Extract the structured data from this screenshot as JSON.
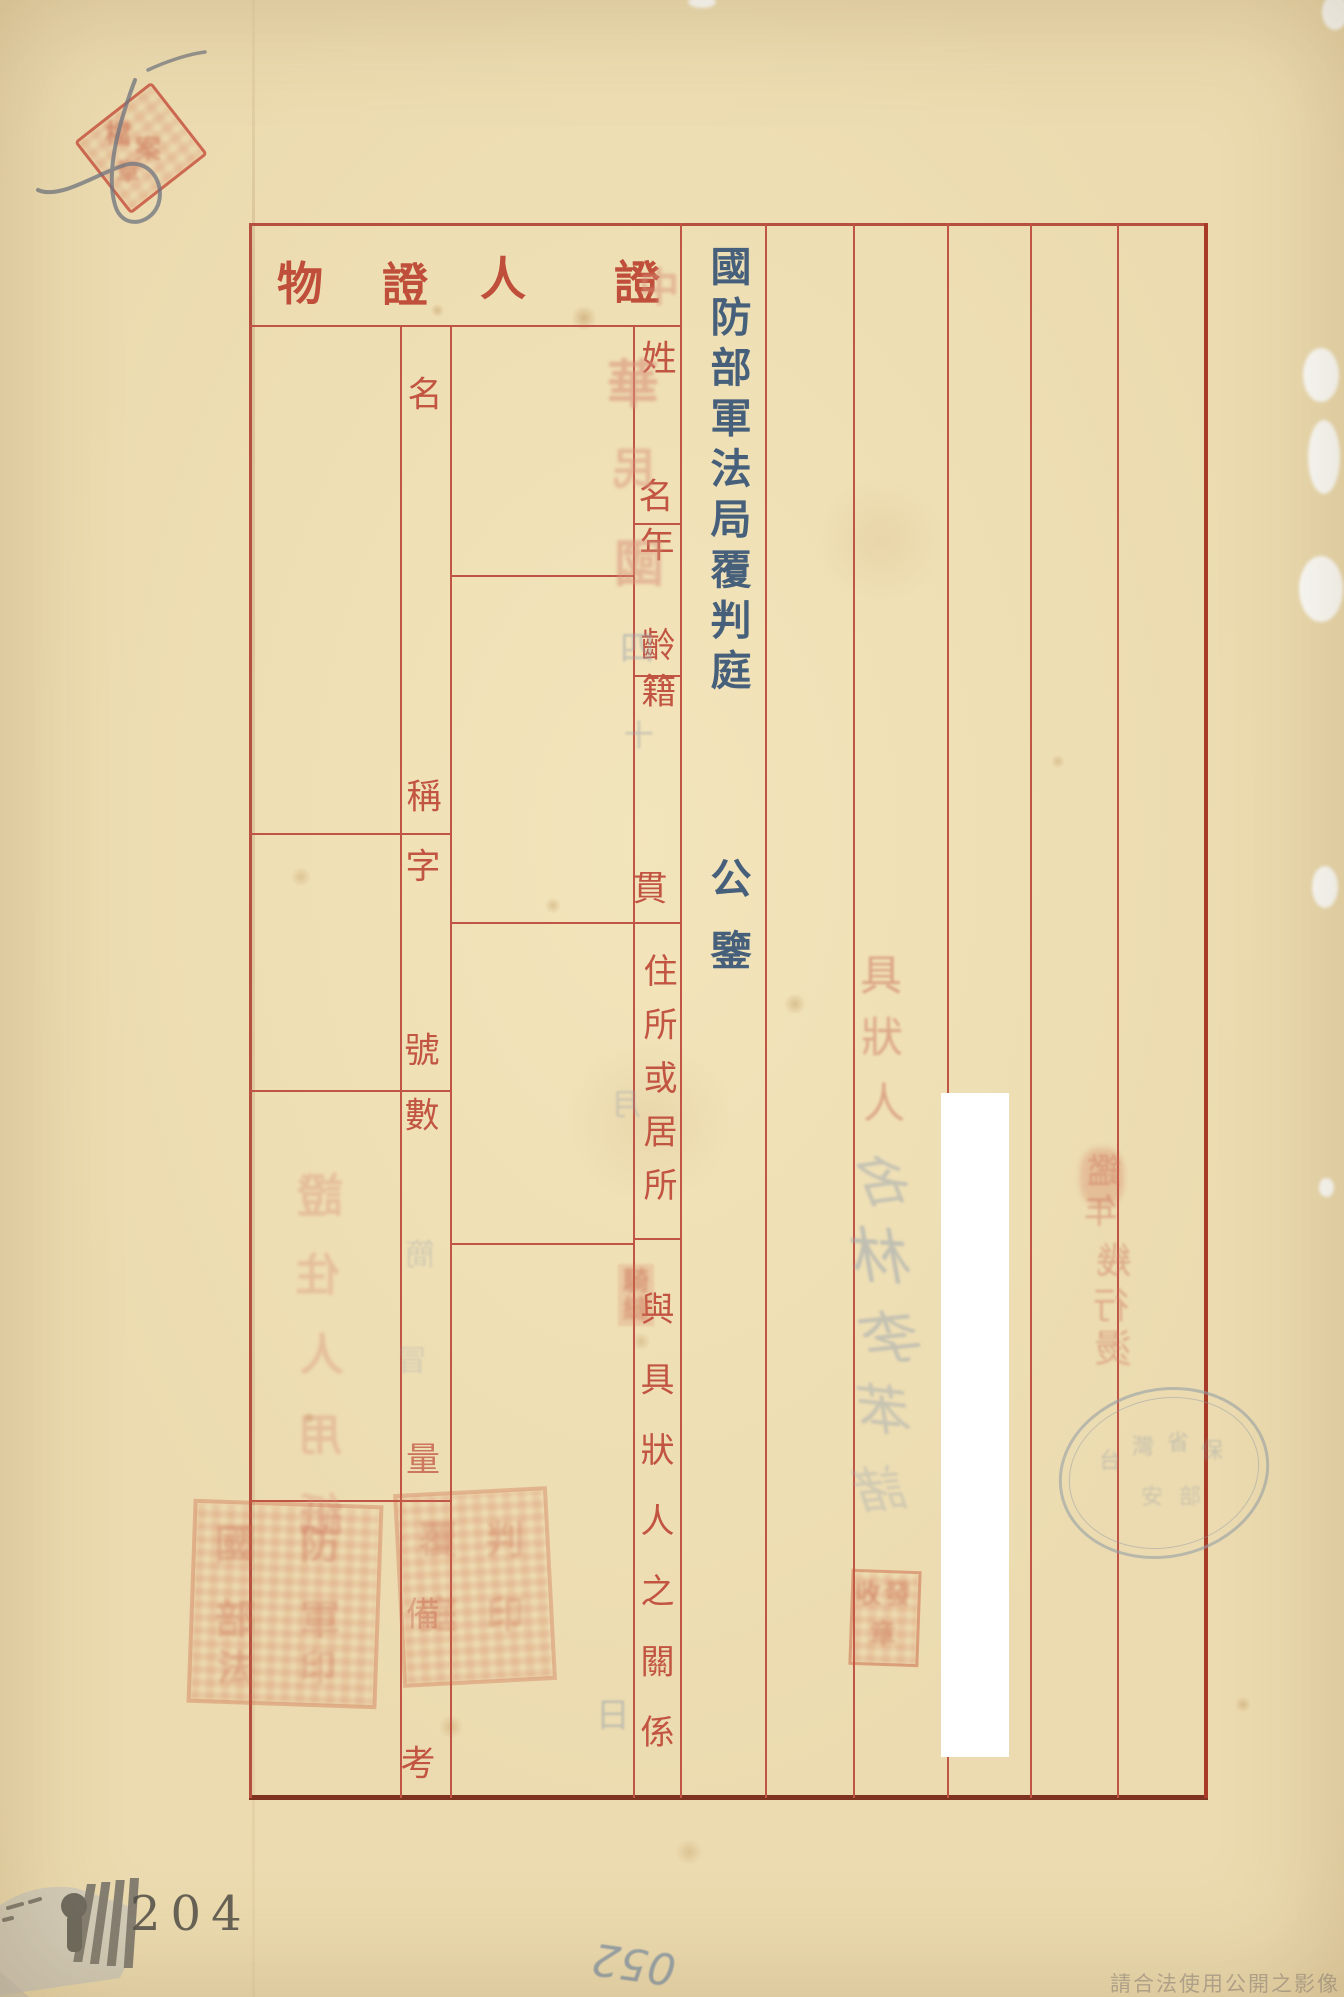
{
  "document": {
    "kind": "archival court form (aged paper, printed red grid, vertical CJK text)",
    "court_title": "國防部軍法局覆判庭",
    "salutation": "公鑒",
    "sections": {
      "witness": {
        "header_display": "人證",
        "fields": [
          "姓名",
          "年齡",
          "籍貫",
          "住所或居所",
          "與具狀人之關係"
        ]
      },
      "evidence": {
        "header_display": "物證",
        "fields": [
          "名稱",
          "字號",
          "數量",
          "備考"
        ]
      }
    }
  },
  "vtexts": {
    "court_title": "國防部軍法局覆判庭",
    "salutation": "公鑒",
    "residence_label": "住所或居所",
    "relationship_label": "與具狀人之關係"
  },
  "footer": {
    "page_number": "204",
    "handwritten_number": "052",
    "watermark": "請合法使用公開之影像"
  },
  "colors": {
    "paper": "#e8d6a9",
    "grid_red": "#c05545",
    "border_dark_red": "#a83b28",
    "label_red": "#c25442",
    "ink_blue": "#46607b",
    "bleed_salmon": "#d8917a",
    "bleed_gray": "#96a1ab",
    "stamp_red": "#c96a50"
  },
  "scatter": {
    "section_headers": [
      {
        "t": "物",
        "x": 300,
        "y": 284,
        "s": 46,
        "cls": "hdr"
      },
      {
        "t": "證",
        "x": 405,
        "y": 285,
        "s": 46,
        "cls": "hdr"
      },
      {
        "t": "人",
        "x": 503,
        "y": 279,
        "s": 46,
        "cls": "hdr"
      },
      {
        "t": "證",
        "x": 637,
        "y": 283,
        "s": 46,
        "cls": "hdr"
      }
    ],
    "evidence_field_chars": [
      {
        "t": "名",
        "x": 425,
        "y": 396,
        "s": 35,
        "cls": "lbl"
      },
      {
        "t": "稱",
        "x": 424,
        "y": 798,
        "s": 35,
        "cls": "lbl"
      },
      {
        "t": "字",
        "x": 423,
        "y": 868,
        "s": 35,
        "cls": "lbl"
      },
      {
        "t": "號",
        "x": 422,
        "y": 1052,
        "s": 35,
        "cls": "lbl"
      },
      {
        "t": "數",
        "x": 422,
        "y": 1117,
        "s": 35,
        "cls": "lbl"
      },
      {
        "t": "量",
        "x": 423,
        "y": 1460,
        "s": 34,
        "cls": "lbl",
        "o": 0.75
      },
      {
        "t": "備",
        "x": 423,
        "y": 1615,
        "s": 34,
        "cls": "lbl",
        "o": 0.35
      },
      {
        "t": "考",
        "x": 418,
        "y": 1765,
        "s": 35,
        "cls": "lbl"
      }
    ],
    "witness_field_chars": [
      {
        "t": "姓",
        "x": 659,
        "y": 360,
        "s": 35,
        "cls": "lbl"
      },
      {
        "t": "名",
        "x": 656,
        "y": 498,
        "s": 35,
        "cls": "lbl"
      },
      {
        "t": "年",
        "x": 657,
        "y": 547,
        "s": 35,
        "cls": "lbl"
      },
      {
        "t": "齡",
        "x": 658,
        "y": 647,
        "s": 35,
        "cls": "lbl"
      },
      {
        "t": "籍",
        "x": 659,
        "y": 693,
        "s": 35,
        "cls": "lbl"
      },
      {
        "t": "貫",
        "x": 650,
        "y": 890,
        "s": 35,
        "cls": "lbl"
      }
    ],
    "bleed_date_red": [
      {
        "t": "中",
        "x": 659,
        "y": 288,
        "s": 40,
        "cls": "bldr",
        "o": 0.55,
        "m": 1
      },
      {
        "t": "華",
        "x": 633,
        "y": 386,
        "s": 52,
        "cls": "bldr",
        "o": 0.6,
        "m": 1
      },
      {
        "t": "民",
        "x": 633,
        "y": 470,
        "s": 44,
        "cls": "bldr",
        "o": 0.5,
        "m": 1
      },
      {
        "t": "國",
        "x": 639,
        "y": 564,
        "s": 50,
        "cls": "bldr",
        "o": 0.55,
        "m": 1
      }
    ],
    "bleed_date_gray": [
      {
        "t": "四",
        "x": 637,
        "y": 649,
        "s": 34,
        "cls": "bldg",
        "o": 0.5,
        "m": 1
      },
      {
        "t": "十",
        "x": 639,
        "y": 737,
        "s": 30,
        "cls": "bldg",
        "o": 0.45,
        "m": 1
      },
      {
        "t": "月",
        "x": 626,
        "y": 1106,
        "s": 30,
        "cls": "bldg",
        "o": 0.4,
        "m": 1
      },
      {
        "t": "日",
        "x": 613,
        "y": 1716,
        "s": 34,
        "cls": "bldg",
        "o": 0.5,
        "m": 1
      }
    ],
    "bleed_deponent": [
      {
        "t": "具",
        "x": 881,
        "y": 976,
        "s": 42,
        "cls": "bldr2",
        "o": 0.6
      },
      {
        "t": "狀",
        "x": 882,
        "y": 1038,
        "s": 42,
        "cls": "bldr2",
        "o": 0.55
      },
      {
        "t": "人",
        "x": 884,
        "y": 1104,
        "s": 42,
        "cls": "bldr2",
        "o": 0.55
      }
    ],
    "handwriting_gray": [
      {
        "t": "名",
        "x": 887,
        "y": 1182,
        "s": 54,
        "cls": "hand",
        "o": 0.5,
        "m": 1,
        "r": 8
      },
      {
        "t": "林",
        "x": 885,
        "y": 1258,
        "s": 60,
        "cls": "hand",
        "o": 0.55,
        "m": 1,
        "r": -4
      },
      {
        "t": "李",
        "x": 896,
        "y": 1338,
        "s": 58,
        "cls": "hand",
        "o": 0.5,
        "m": 1,
        "r": 6
      },
      {
        "t": "苯",
        "x": 888,
        "y": 1412,
        "s": 54,
        "cls": "hand",
        "o": 0.45,
        "m": 1,
        "r": -6
      },
      {
        "t": "諸",
        "x": 884,
        "y": 1490,
        "s": 50,
        "cls": "hand",
        "o": 0.35,
        "m": 1,
        "r": 5
      }
    ],
    "bleed_right_column": [
      {
        "t": "鑑",
        "x": 1104,
        "y": 1172,
        "s": 34,
        "cls": "bldr2",
        "o": 0.5,
        "m": 1
      },
      {
        "t": "年",
        "x": 1101,
        "y": 1212,
        "s": 34,
        "cls": "bldr2",
        "o": 0.5,
        "m": 1
      },
      {
        "t": "幾",
        "x": 1114,
        "y": 1262,
        "s": 36,
        "cls": "bldr2",
        "o": 0.5,
        "m": 1
      },
      {
        "t": "行",
        "x": 1111,
        "y": 1307,
        "s": 36,
        "cls": "bldr2",
        "o": 0.5,
        "m": 1
      },
      {
        "t": "燙",
        "x": 1113,
        "y": 1349,
        "s": 38,
        "cls": "bldr2",
        "o": 0.5,
        "m": 1
      }
    ],
    "bleed_left_column": [
      {
        "t": "證",
        "x": 320,
        "y": 1196,
        "s": 46,
        "cls": "bldr",
        "o": 0.42,
        "m": 1
      },
      {
        "t": "住",
        "x": 318,
        "y": 1276,
        "s": 44,
        "cls": "bldr",
        "o": 0.4,
        "m": 1
      },
      {
        "t": "人",
        "x": 322,
        "y": 1356,
        "s": 44,
        "cls": "bldr",
        "o": 0.4,
        "m": 1
      },
      {
        "t": "用",
        "x": 320,
        "y": 1436,
        "s": 44,
        "cls": "bldr",
        "o": 0.4,
        "m": 1
      },
      {
        "t": "紙",
        "x": 321,
        "y": 1516,
        "s": 44,
        "cls": "bldr",
        "o": 0.38,
        "m": 1
      }
    ],
    "bleed_gray_small": [
      {
        "t": "簡",
        "x": 420,
        "y": 1256,
        "s": 30,
        "cls": "bldg",
        "o": 0.32,
        "m": 1
      },
      {
        "t": "冒",
        "x": 412,
        "y": 1362,
        "s": 30,
        "cls": "bldg",
        "o": 0.3,
        "m": 1
      }
    ],
    "stamp_a_chars": [
      {
        "t": "國",
        "x": 235,
        "y": 1545,
        "s": 40,
        "cls": "sealc",
        "o": 0.35
      },
      {
        "t": "防",
        "x": 320,
        "y": 1545,
        "s": 40,
        "cls": "sealc",
        "o": 0.32
      },
      {
        "t": "部",
        "x": 235,
        "y": 1620,
        "s": 40,
        "cls": "sealc",
        "o": 0.33
      },
      {
        "t": "軍",
        "x": 320,
        "y": 1620,
        "s": 40,
        "cls": "sealc",
        "o": 0.3
      },
      {
        "t": "法",
        "x": 235,
        "y": 1668,
        "s": 36,
        "cls": "sealc",
        "o": 0.3
      },
      {
        "t": "印",
        "x": 318,
        "y": 1668,
        "s": 36,
        "cls": "sealc",
        "o": 0.28
      }
    ],
    "stamp_b_chars": [
      {
        "t": "覆",
        "x": 438,
        "y": 1540,
        "s": 38,
        "cls": "sealc",
        "o": 0.33
      },
      {
        "t": "判",
        "x": 505,
        "y": 1540,
        "s": 38,
        "cls": "sealc",
        "o": 0.3
      },
      {
        "t": "庭",
        "x": 438,
        "y": 1615,
        "s": 38,
        "cls": "sealc",
        "o": 0.3
      },
      {
        "t": "印",
        "x": 505,
        "y": 1615,
        "s": 38,
        "cls": "sealc",
        "o": 0.28
      }
    ],
    "stamp_c_chars": [
      {
        "t": "收",
        "x": 868,
        "y": 1595,
        "s": 26,
        "cls": "sealc",
        "o": 0.5
      },
      {
        "t": "發",
        "x": 898,
        "y": 1595,
        "s": 26,
        "cls": "sealc",
        "o": 0.45
      },
      {
        "t": "章",
        "x": 883,
        "y": 1635,
        "s": 26,
        "cls": "sealc",
        "o": 0.45
      }
    ],
    "stamp_small_chars": [
      {
        "t": "騎",
        "x": 636,
        "y": 1282,
        "s": 26,
        "cls": "sealc",
        "o": 0.5
      },
      {
        "t": "縫",
        "x": 636,
        "y": 1310,
        "s": 26,
        "cls": "sealc",
        "o": 0.45
      }
    ],
    "corner_stamp_chars": [
      {
        "t": "檔",
        "x": 118,
        "y": 135,
        "s": 26,
        "cls": "sealc",
        "o": 0.6
      },
      {
        "t": "案",
        "x": 148,
        "y": 150,
        "s": 26,
        "cls": "sealc",
        "o": 0.55
      },
      {
        "t": "章",
        "x": 128,
        "y": 172,
        "s": 24,
        "cls": "sealc",
        "o": 0.5
      }
    ],
    "oval_chars": [
      {
        "t": "台",
        "x": 1110,
        "y": 1462,
        "s": 22,
        "cls": "ovalc",
        "o": 0.4
      },
      {
        "t": "灣",
        "x": 1143,
        "y": 1448,
        "s": 22,
        "cls": "ovalc",
        "o": 0.42
      },
      {
        "t": "省",
        "x": 1178,
        "y": 1444,
        "s": 22,
        "cls": "ovalc",
        "o": 0.4
      },
      {
        "t": "保",
        "x": 1212,
        "y": 1452,
        "s": 22,
        "cls": "ovalc",
        "o": 0.38
      },
      {
        "t": "安",
        "x": 1152,
        "y": 1498,
        "s": 22,
        "cls": "ovalc",
        "o": 0.35
      },
      {
        "t": "部",
        "x": 1190,
        "y": 1498,
        "s": 22,
        "cls": "ovalc",
        "o": 0.35
      }
    ]
  }
}
